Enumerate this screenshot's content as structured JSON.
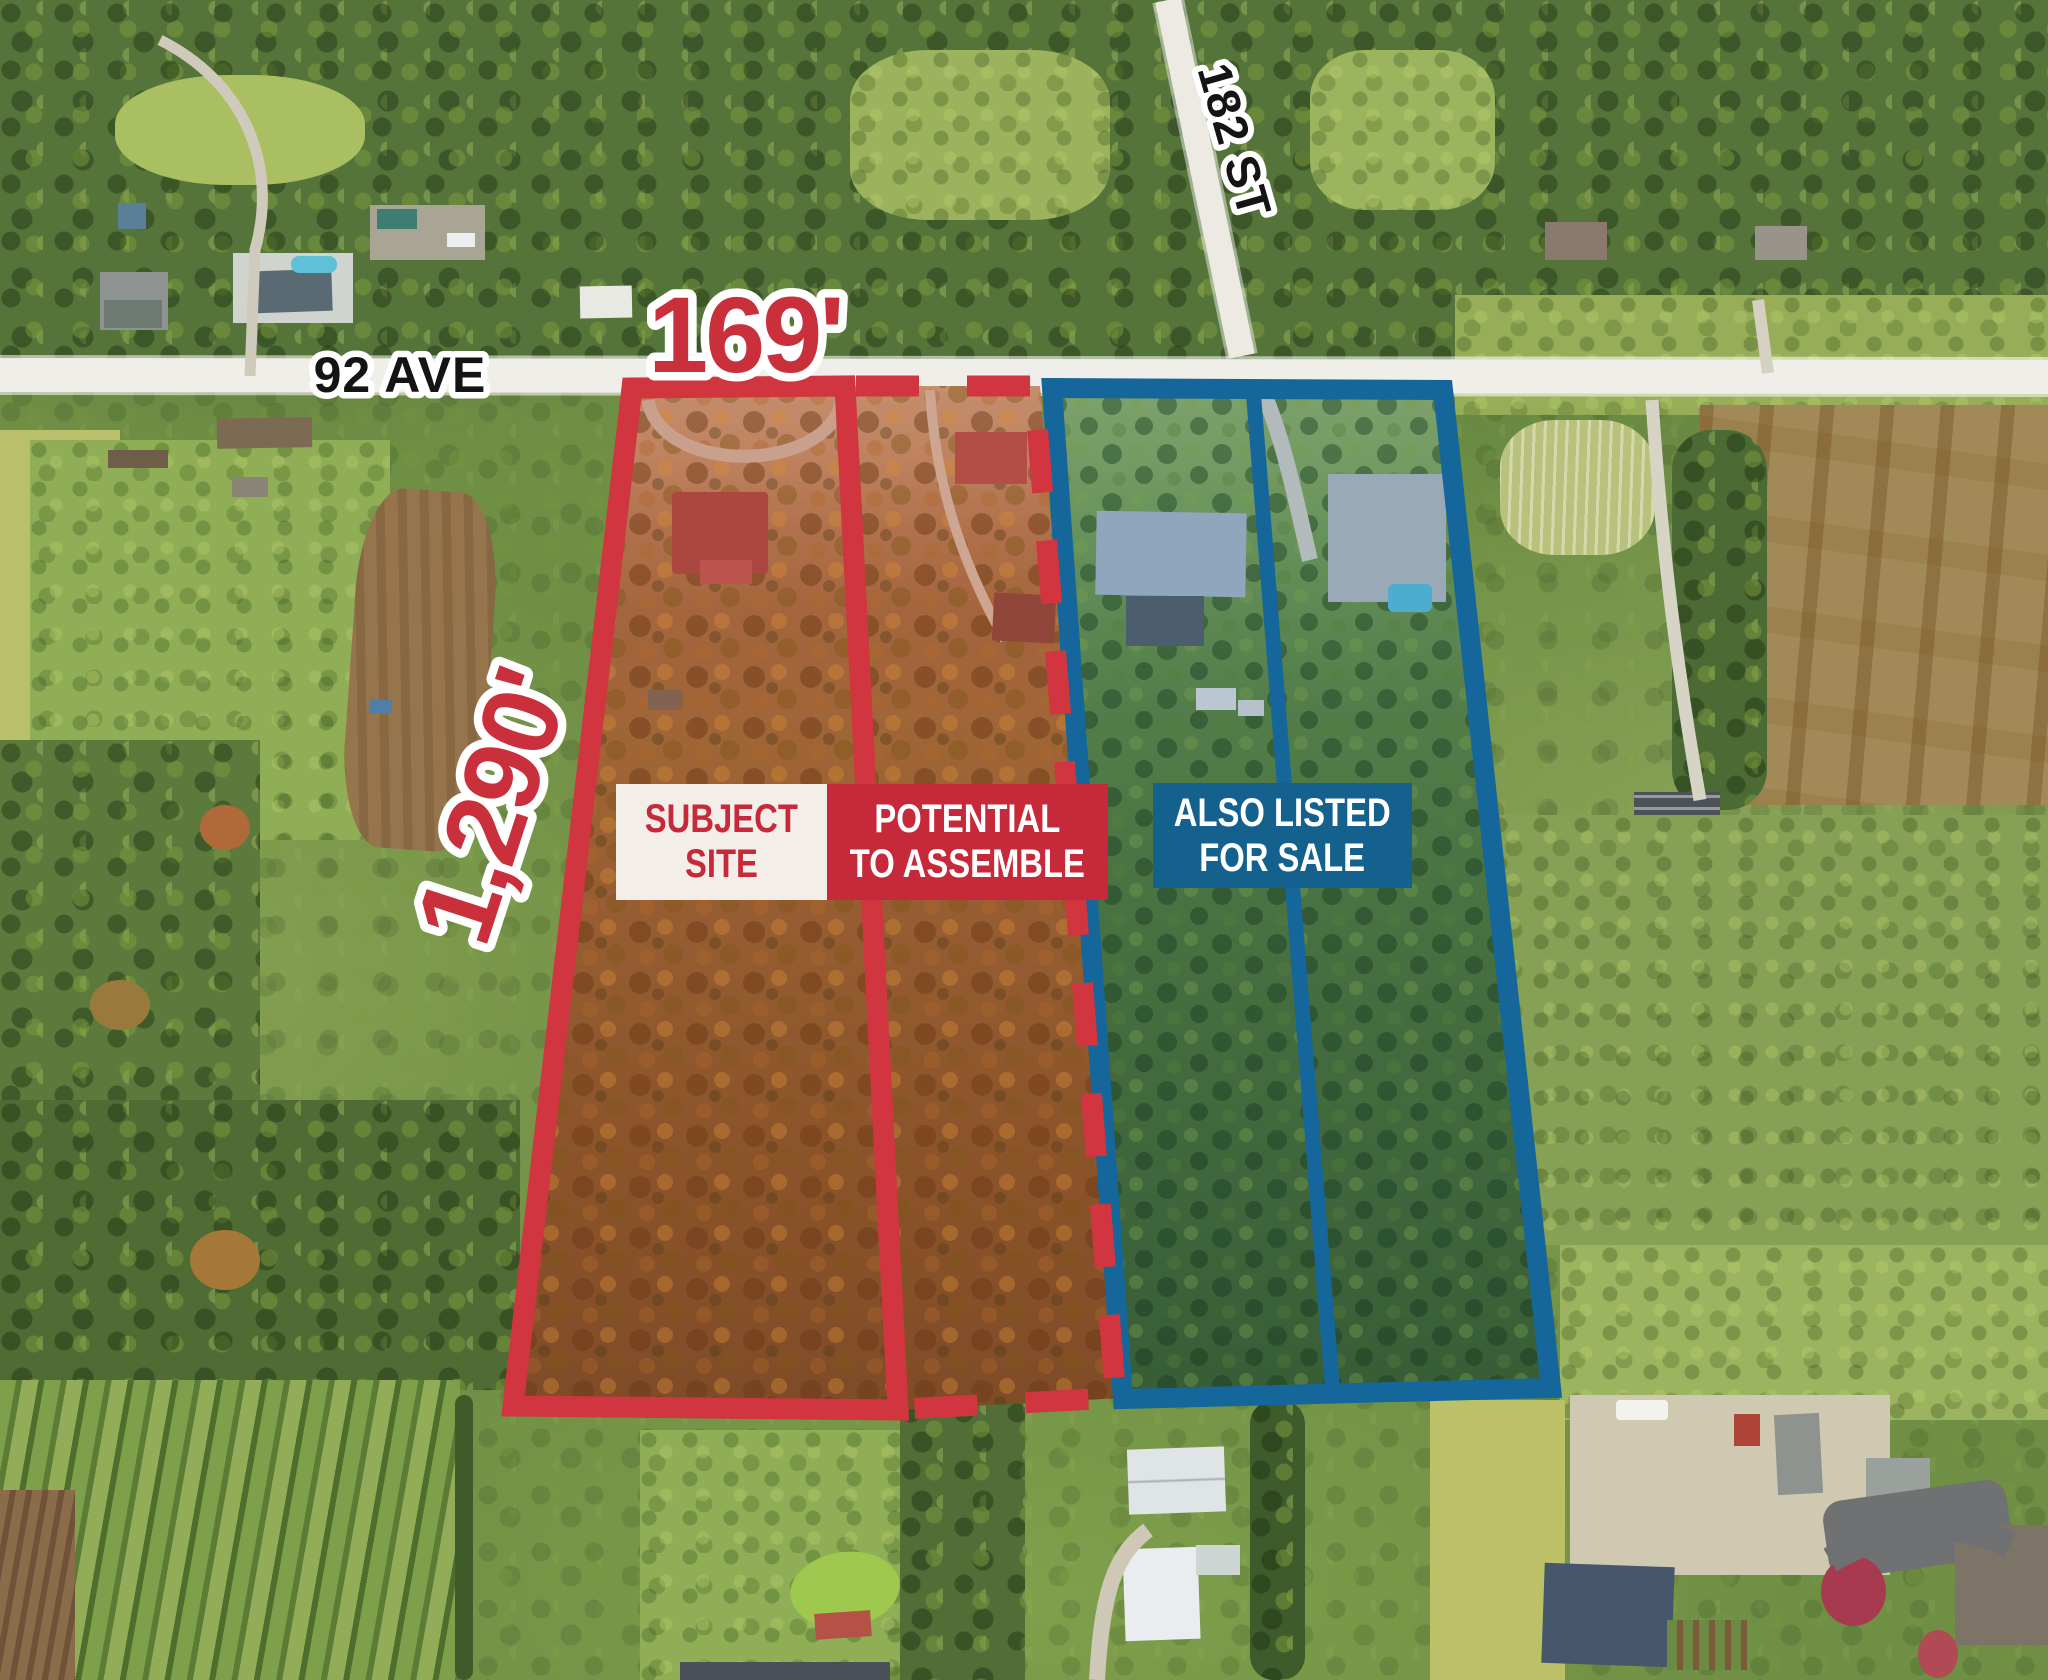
{
  "map": {
    "dimension_width": "169'",
    "dimension_depth": "1,290'",
    "street_horizontal": "92 AVE",
    "street_vertical": "182 ST",
    "boxes": {
      "subject": {
        "line1": "SUBJECT",
        "line2": "SITE"
      },
      "assemble": {
        "line1": "POTENTIAL",
        "line2": "TO ASSEMBLE"
      },
      "listed": {
        "line1": "ALSO LISTED",
        "line2": "FOR SALE"
      }
    },
    "parcels": [
      {
        "name": "subject-site",
        "outline": "solid red"
      },
      {
        "name": "potential-to-assemble",
        "outline": "dashed red"
      },
      {
        "name": "also-listed-lot-west",
        "outline": "solid blue"
      },
      {
        "name": "also-listed-lot-east",
        "outline": "solid blue"
      }
    ],
    "colors": {
      "red": "#C5293A",
      "blue": "#15618E",
      "box_white": "#F3EFE8",
      "road": "#DED9CC"
    }
  }
}
